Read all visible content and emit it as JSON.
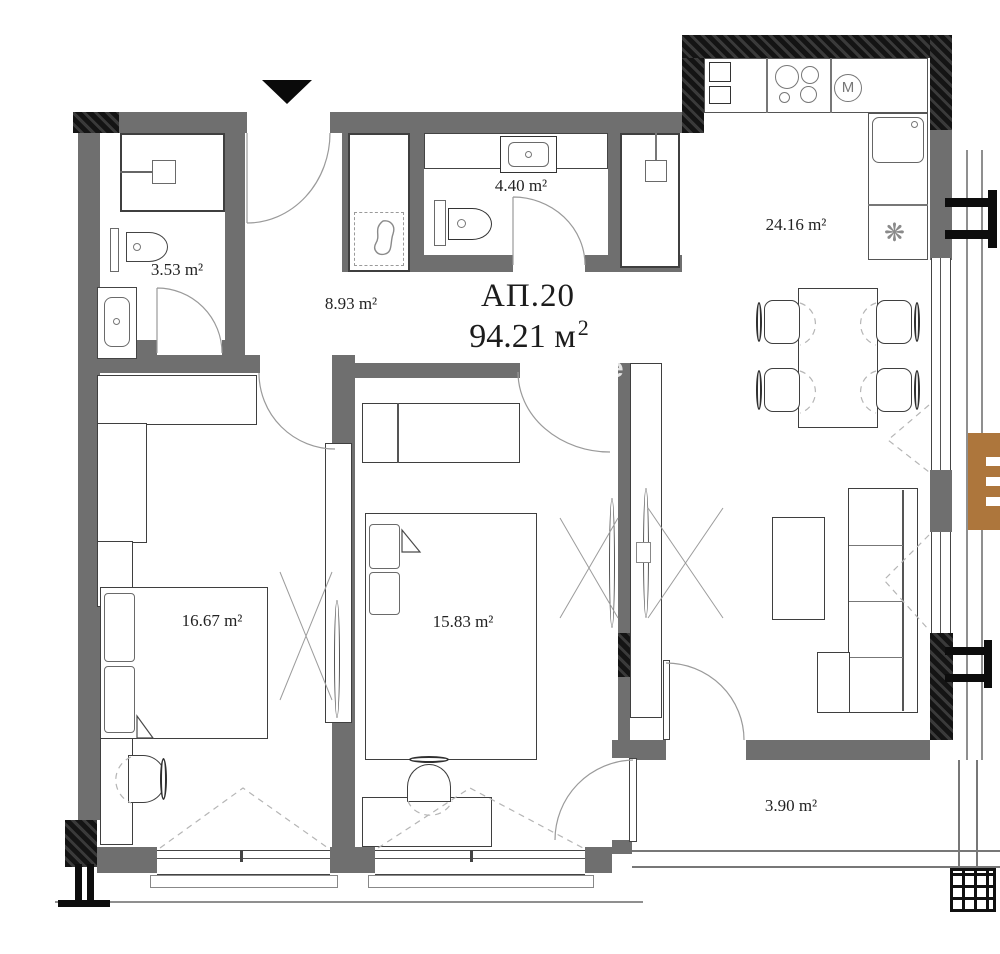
{
  "plan": {
    "title": "АП.20",
    "total_area": "94.21 м²",
    "total_area_main": "94.21 м",
    "total_area_sup": "2",
    "rooms": {
      "bathroom1": "3.53 m²",
      "hallway": "8.93 m²",
      "bathroom2": "4.40 m²",
      "kitchen_living": "24.16 m²",
      "bedroom1": "16.67 m²",
      "bedroom2": "15.83 m²",
      "balcony": "3.90 m²"
    },
    "icons": {
      "appliance_m": "M",
      "fridge": "❋"
    },
    "watermark": "e",
    "colors": {
      "wall": "#6f6f6f",
      "structure": "#141414",
      "logo_accent": "#ad763c"
    }
  }
}
